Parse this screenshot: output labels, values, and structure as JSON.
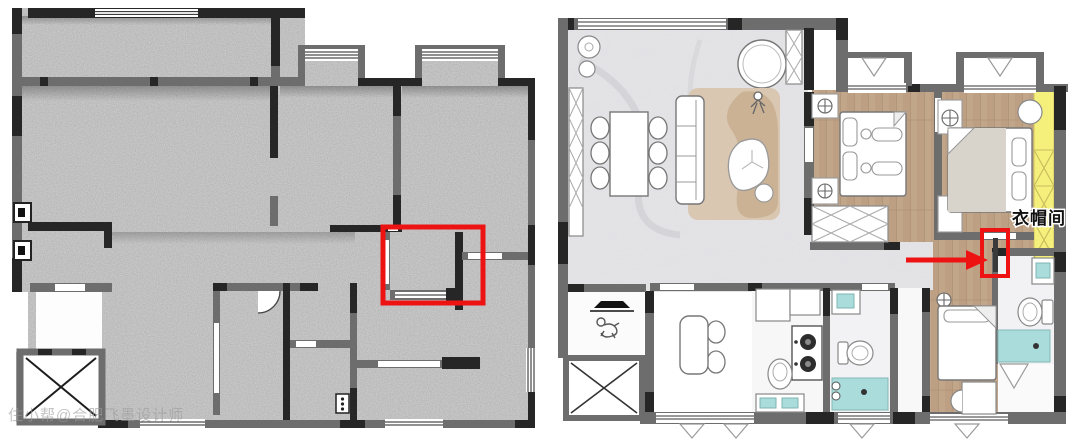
{
  "page": {
    "description": "side-by-side floor plans: original concrete structure plan (left) and furnished layout plan (right)",
    "background": "#ffffff"
  },
  "left_plan": {
    "kind": "original-structure-plan",
    "watermark": "住小帮@合肥飞墨设计师",
    "highlight_box_color": "#ee1313"
  },
  "right_plan": {
    "kind": "furnished-layout-plan",
    "labels": {
      "closet": "衣帽间"
    },
    "annotation": {
      "arrow_color": "#ee1313",
      "highlight_box_color": "#ee1313",
      "closet_highlight_color": "#f5f07c"
    }
  },
  "palette": {
    "wall_dark": "#262626",
    "wall_gray": "#6d6d6d",
    "concrete_floor": "#b2b2b2",
    "marble_floor": "#e3e3e6",
    "wood_floor": "#bda084",
    "shower_teal": "#a9dcda",
    "rug_beige": "#d9c7b2",
    "rug_tan": "#c8ae8f"
  },
  "icons": {
    "elevator": "elevator-x-icon",
    "door_swing": "door-arc-icon",
    "downlight": "circle-cross-icon",
    "curtain": "triangle-valance-icon",
    "person": "person-figure-icon",
    "pet": "pet-figure-icon"
  }
}
